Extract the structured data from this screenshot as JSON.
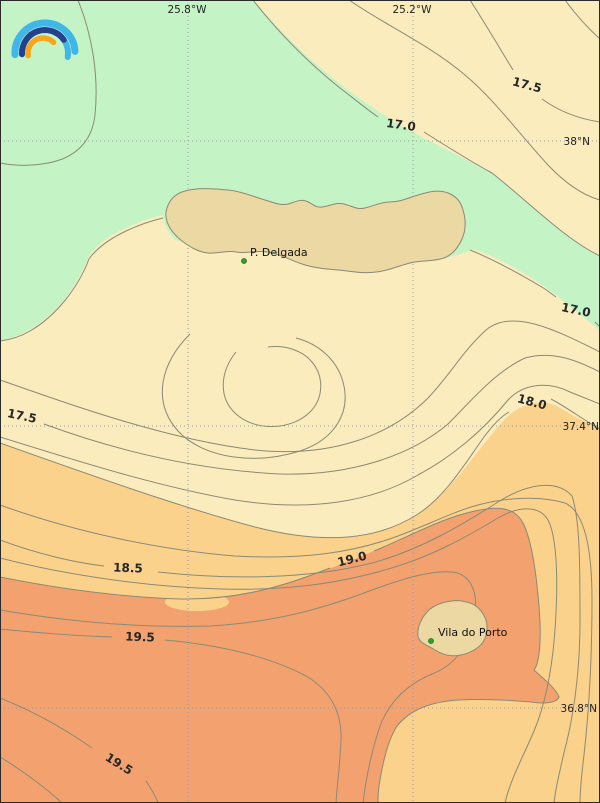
{
  "map": {
    "description": "Filled contour map of sea surface temperature (°C) around the Azores",
    "logo_icon": "rainbow-arcs-logo",
    "colors": {
      "band_below_17": "#c4f3c6",
      "band_17_18": "#fbecbd",
      "band_18_19": "#fad28c",
      "band_above_19": "#f3a26f",
      "island_fill": "#ebd8a2",
      "contour_line": "#8b8a75",
      "grid_line": "#9b9b9b",
      "place_marker": "#2ca02c",
      "logo_light_blue": "#41b6e8",
      "logo_dark_blue": "#24418e",
      "logo_orange": "#f7a51b"
    },
    "coord_labels": [
      {
        "text": "25.8°W"
      },
      {
        "text": "25.2°W"
      },
      {
        "text": "38°N"
      },
      {
        "text": "37.4°N"
      },
      {
        "text": "36.8°N"
      }
    ],
    "contour_labels": [
      {
        "text": "17.5"
      },
      {
        "text": "17.0"
      },
      {
        "text": "17.0"
      },
      {
        "text": "18.0"
      },
      {
        "text": "17.5"
      },
      {
        "text": "18.5"
      },
      {
        "text": "19.0"
      },
      {
        "text": "19.5"
      },
      {
        "text": "19.5"
      }
    ],
    "places": [
      {
        "name": "P. Delgada"
      },
      {
        "name": "Vila do Porto"
      }
    ]
  },
  "chart_data": {
    "type": "contour_map",
    "subject": "Sea surface temperature isotherms (°C) around the Azores archipelago",
    "x_axis": {
      "ticks": [
        "25.8°W",
        "25.2°W"
      ],
      "grid": true
    },
    "y_axis": {
      "ticks": [
        "38°N",
        "37.4°N",
        "36.8°N"
      ],
      "grid": true
    },
    "contour_interval": 0.25,
    "labeled_levels": [
      17.0,
      17.5,
      18.0,
      18.5,
      19.0,
      19.5
    ],
    "visible_contour_label_instances": [
      {
        "level": 17.5,
        "area": "upper-right"
      },
      {
        "level": 17.0,
        "area": "top-center"
      },
      {
        "level": 17.0,
        "area": "right-middle"
      },
      {
        "level": 18.0,
        "area": "right-middle"
      },
      {
        "level": 17.5,
        "area": "left-middle"
      },
      {
        "level": 18.5,
        "area": "left-lower"
      },
      {
        "level": 19.0,
        "area": "center-lower"
      },
      {
        "level": 19.5,
        "area": "left-bottom"
      },
      {
        "level": 19.5,
        "area": "bottom-left-corner"
      }
    ],
    "filled_bands": [
      {
        "range": "< 17.0",
        "color": "#c4f3c6",
        "location": "north / around São Miguel"
      },
      {
        "range": "17.0 - 18.0",
        "color": "#fbecbd",
        "location": "central belt"
      },
      {
        "range": "18.0 - 19.0",
        "color": "#fad28c",
        "location": "south-central belt and east strip"
      },
      {
        "range": ">= 19.0",
        "color": "#f3a26f",
        "location": "southern area around Santa Maria"
      }
    ],
    "places": [
      {
        "name": "P. Delgada",
        "marker": "green dot",
        "on": "large northern island"
      },
      {
        "name": "Vila do Porto",
        "marker": "green dot",
        "on": "small southern island"
      }
    ],
    "legend": false
  }
}
